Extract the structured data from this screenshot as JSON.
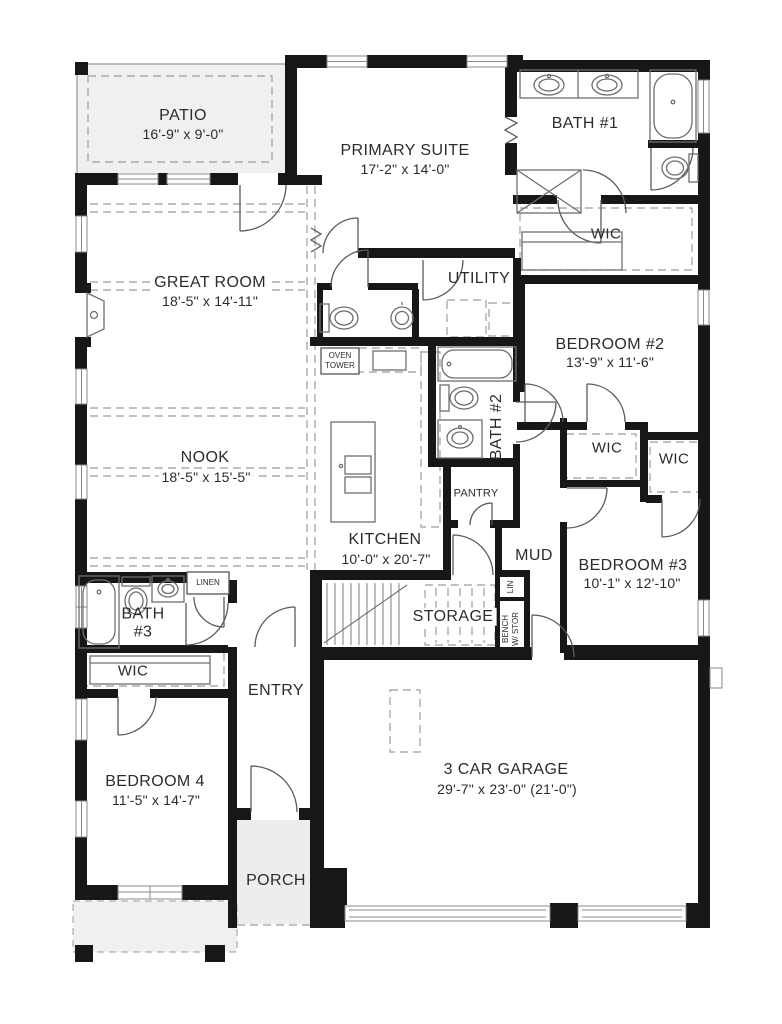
{
  "colors": {
    "wall": "#171717",
    "fixture_line": "#6e6e6e",
    "dashed_line": "#9c9c9c",
    "patio_fill": "#f0f0f0",
    "porch_fill": "#ededed",
    "text": "#2c2c2c"
  },
  "rooms": {
    "patio": {
      "name": "PATIO",
      "dims": "16'-9\" x 9'-0\""
    },
    "primary_suite": {
      "name": "PRIMARY SUITE",
      "dims": "17'-2\" x 14'-0\""
    },
    "bath_1": {
      "name": "BATH #1"
    },
    "primary_wic": {
      "name": "WIC"
    },
    "great_room": {
      "name": "GREAT ROOM",
      "dims": "18'-5\" x 14'-11\""
    },
    "utility": {
      "name": "UTILITY"
    },
    "oven_tower": {
      "name": "OVEN\nTOWER"
    },
    "bedroom_2": {
      "name": "BEDROOM #2",
      "dims": "13'-9\" x 11'-6\""
    },
    "bath_2": {
      "name": "BATH #2"
    },
    "wic_bedroom_2": {
      "name": "WIC"
    },
    "wic_bedroom_3": {
      "name": "WIC"
    },
    "nook": {
      "name": "NOOK",
      "dims": "18'-5\" x 15'-5\""
    },
    "kitchen": {
      "name": "KITCHEN",
      "dims": "10'-0\" x 20'-7\""
    },
    "pantry": {
      "name": "PANTRY"
    },
    "mud": {
      "name": "MUD"
    },
    "bedroom_3": {
      "name": "BEDROOM #3",
      "dims": "10'-1\" x 12'-10\""
    },
    "bath_3": {
      "name": "BATH\n#3"
    },
    "linen": {
      "name": "LINEN"
    },
    "wic_bedroom_4": {
      "name": "WIC"
    },
    "entry": {
      "name": "ENTRY"
    },
    "storage": {
      "name": "STORAGE"
    },
    "bench": {
      "name": "BENCH\nW/ STOR"
    },
    "lin": {
      "name": "LIN"
    },
    "bedroom_4": {
      "name": "BEDROOM 4",
      "dims": "11'-5\" x 14'-7\""
    },
    "garage": {
      "name": "3 CAR GARAGE",
      "dims": "29'-7\" x 23'-0\" (21'-0\")"
    },
    "porch": {
      "name": "PORCH"
    }
  }
}
